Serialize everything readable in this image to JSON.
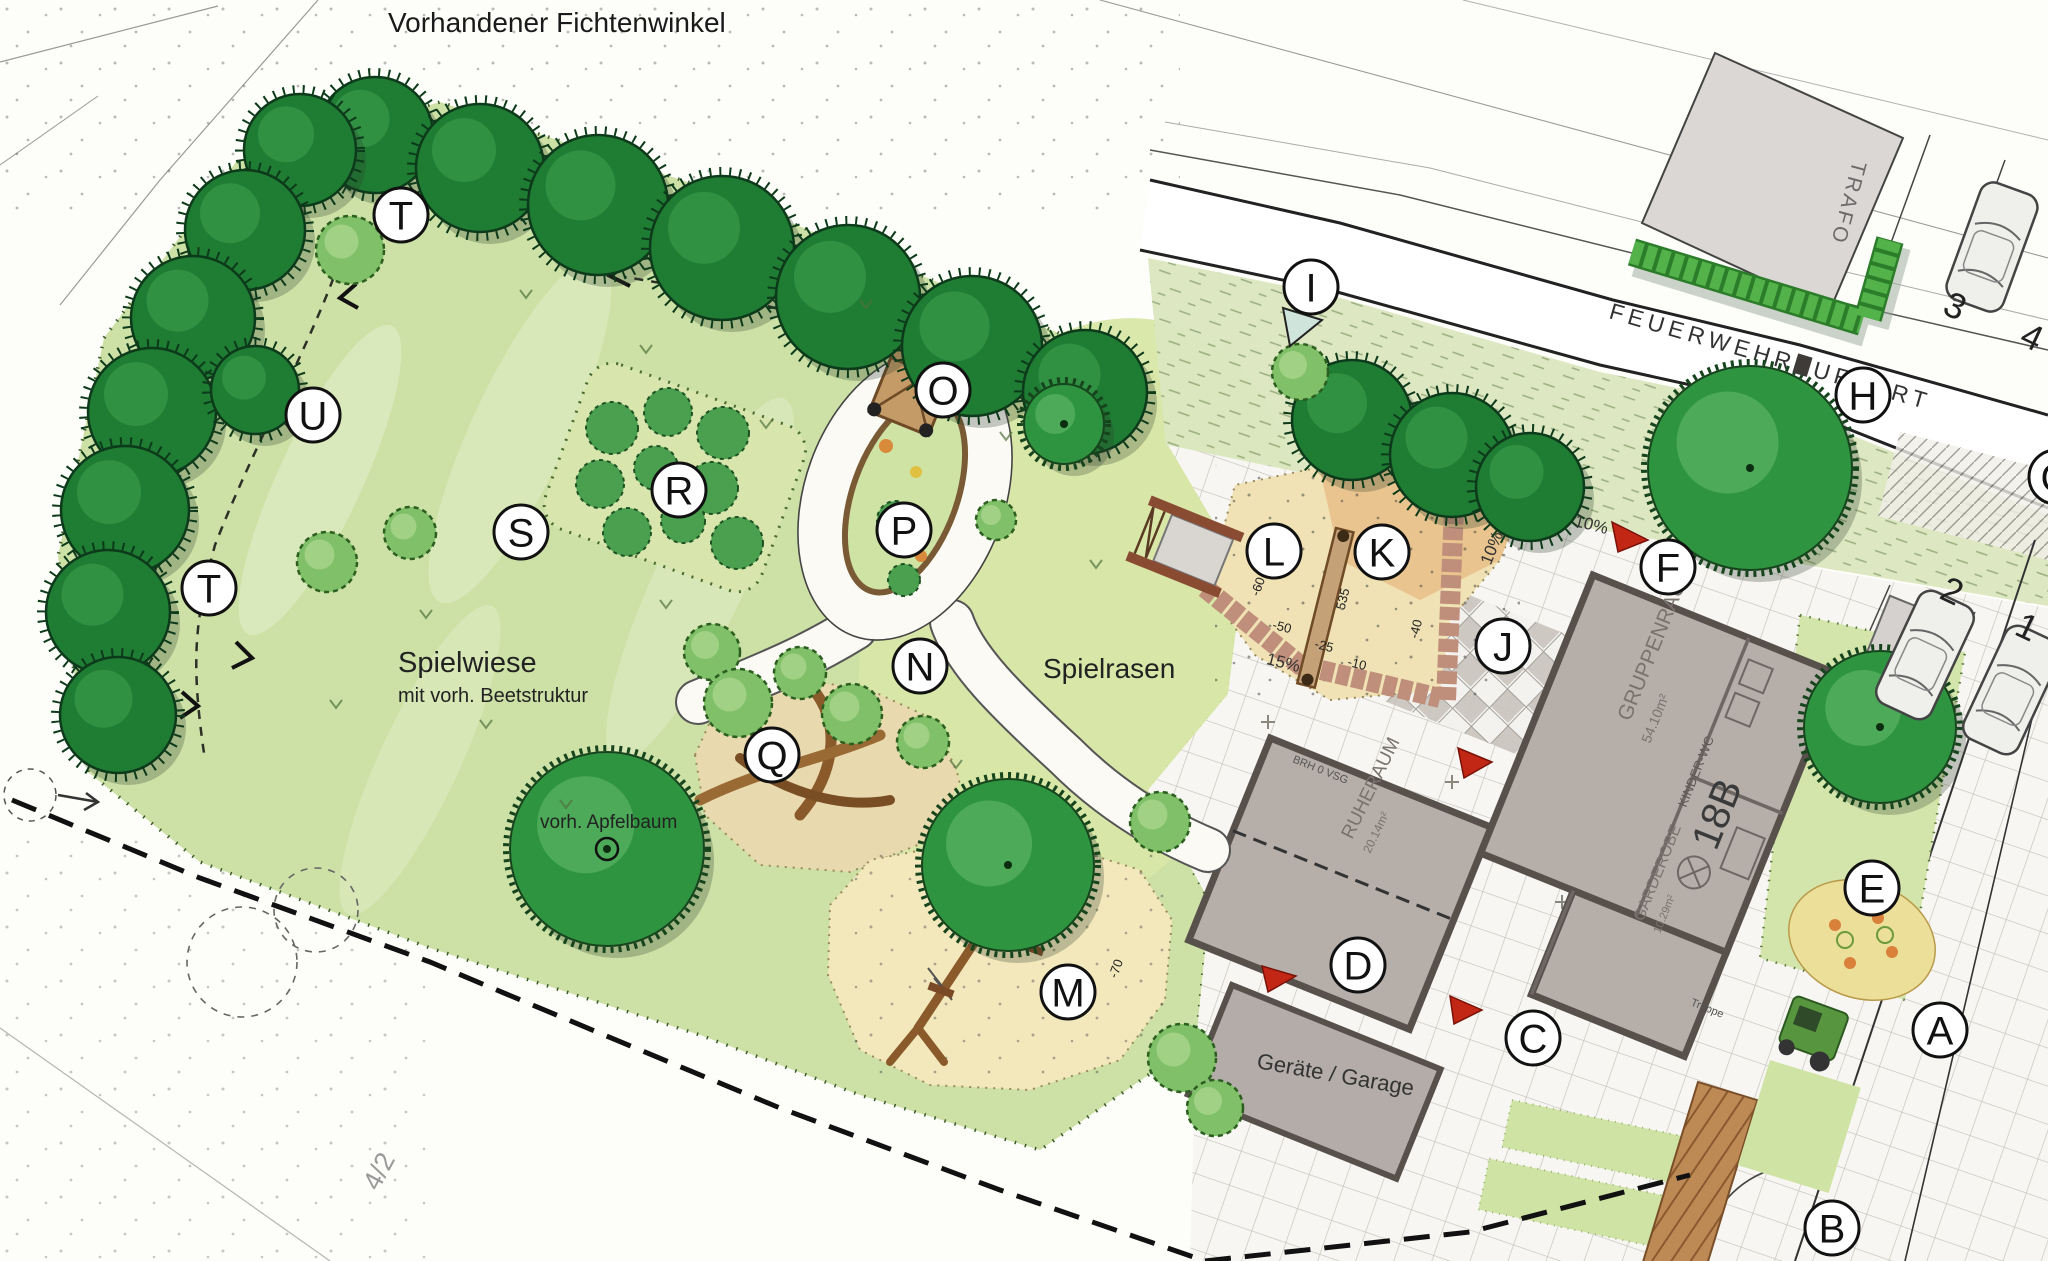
{
  "title": "Vorhandener Fichtenwinkel",
  "labels": {
    "spielwiese": "Spielwiese",
    "spielwiese_sub": "mit vorh. Beetstruktur",
    "spielrasen": "Spielrasen",
    "apfelbaum": "vorh. Apfelbaum",
    "garage": "Geräte / Garage",
    "street": "FEUERWEHRZUFAHRT",
    "trafo": "TRAFO",
    "parcel": "4/2"
  },
  "building": {
    "room1": "GRUPPENRAUM",
    "room1_area": "54.10m²",
    "room2": "RUHERAUM",
    "room2_area": "20.14m²",
    "room3": "GARDEROBE",
    "room3_area": "10.29m²",
    "room4": "KINDER-WC",
    "number": "18B",
    "note1": "BRH 0 VSG",
    "note2": "Treppe"
  },
  "markers": [
    {
      "letter": "T",
      "x": 401,
      "y": 215
    },
    {
      "letter": "U",
      "x": 313,
      "y": 415
    },
    {
      "letter": "T",
      "x": 209,
      "y": 588
    },
    {
      "letter": "S",
      "x": 521,
      "y": 532
    },
    {
      "letter": "R",
      "x": 679,
      "y": 490
    },
    {
      "letter": "O",
      "x": 943,
      "y": 390
    },
    {
      "letter": "P",
      "x": 904,
      "y": 530
    },
    {
      "letter": "N",
      "x": 920,
      "y": 666
    },
    {
      "letter": "Q",
      "x": 772,
      "y": 755
    },
    {
      "letter": "M",
      "x": 1068,
      "y": 992
    },
    {
      "letter": "I",
      "x": 1311,
      "y": 287
    },
    {
      "letter": "H",
      "x": 1863,
      "y": 395
    },
    {
      "letter": "L",
      "x": 1274,
      "y": 551
    },
    {
      "letter": "K",
      "x": 1382,
      "y": 552
    },
    {
      "letter": "J",
      "x": 1503,
      "y": 646
    },
    {
      "letter": "F",
      "x": 1668,
      "y": 567
    },
    {
      "letter": "E",
      "x": 1872,
      "y": 888
    },
    {
      "letter": "D",
      "x": 1358,
      "y": 965
    },
    {
      "letter": "C",
      "x": 1533,
      "y": 1038
    },
    {
      "letter": "A",
      "x": 1940,
      "y": 1030
    },
    {
      "letter": "B",
      "x": 1832,
      "y": 1228
    },
    {
      "letter": "G",
      "x": 2056,
      "y": 477
    }
  ],
  "parking": [
    {
      "label": "3",
      "x": 1950,
      "y": 317,
      "rot": 25
    },
    {
      "label": "4",
      "x": 2027,
      "y": 348,
      "rot": 25
    },
    {
      "label": "2",
      "x": 1947,
      "y": 602,
      "rot": 25
    },
    {
      "label": "1",
      "x": 2022,
      "y": 638,
      "rot": 25
    }
  ],
  "slopes": [
    {
      "text": "10%",
      "x": 1497,
      "y": 550,
      "rot": -68
    },
    {
      "text": "10%",
      "x": 1590,
      "y": 530,
      "rot": 14
    },
    {
      "text": "15%",
      "x": 1282,
      "y": 668,
      "rot": 14
    }
  ],
  "dimensions": [
    {
      "text": "535",
      "x": 1347,
      "y": 600,
      "rot": -76
    },
    {
      "text": "-60",
      "x": 1262,
      "y": 588,
      "rot": -70
    },
    {
      "text": "-50",
      "x": 1281,
      "y": 631,
      "rot": 14
    },
    {
      "text": "-25",
      "x": 1323,
      "y": 650,
      "rot": 14
    },
    {
      "text": "-10",
      "x": 1356,
      "y": 668,
      "rot": 14
    },
    {
      "text": "-40",
      "x": 1420,
      "y": 630,
      "rot": -76
    },
    {
      "text": "-70",
      "x": 1120,
      "y": 970,
      "rot": -70
    }
  ],
  "colors": {
    "meadow": "#cde1a6",
    "spruce": "#1e7c33",
    "tree": "#2f9440",
    "sand": "#f0e2b4",
    "building": "#b5aea9",
    "accentRed": "#c22614",
    "hedge": "#53b24a"
  }
}
